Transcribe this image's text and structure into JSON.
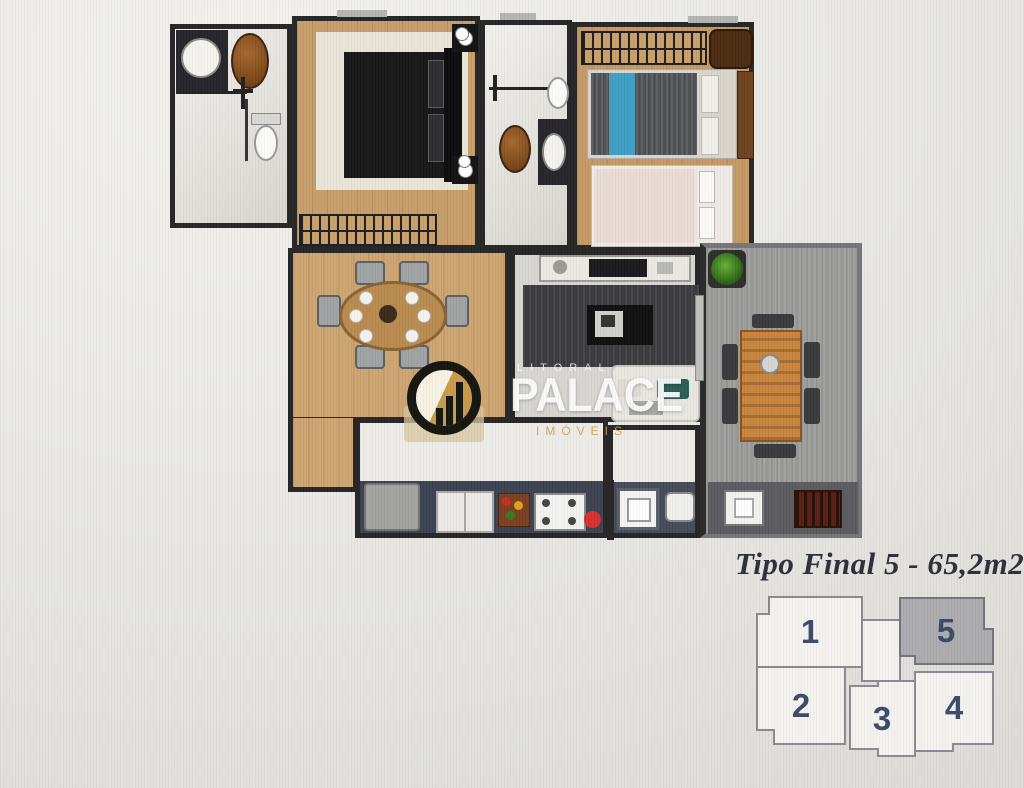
{
  "page": {
    "background": "#eae9e5"
  },
  "watermark": {
    "brand_top": "LITORAL",
    "brand_main": "PALACE",
    "brand_sub": "IMÓVEIS",
    "accent_gold": "#c89b4a"
  },
  "caption": {
    "title": "Tipo Final 5 - 65,2m2",
    "color": "#2d3038"
  },
  "keyplan": {
    "number_color": "#3c4a6a",
    "highlight_fill": "#acacae",
    "units": [
      {
        "label": "1",
        "highlighted": false
      },
      {
        "label": "2",
        "highlighted": false
      },
      {
        "label": "3",
        "highlighted": false
      },
      {
        "label": "4",
        "highlighted": false
      },
      {
        "label": "5",
        "highlighted": true
      }
    ]
  }
}
